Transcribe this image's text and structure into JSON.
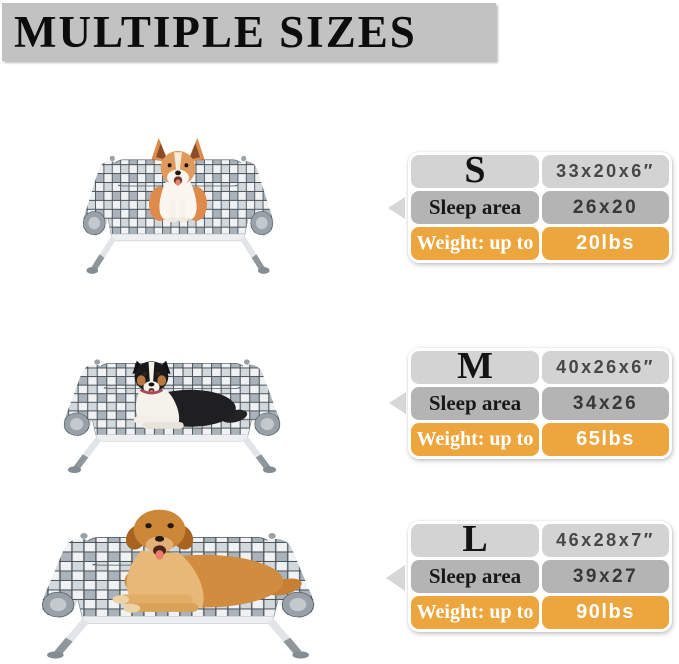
{
  "header": {
    "title": "MULTIPLE SIZES"
  },
  "colors": {
    "banner_bg": "#c2c2c2",
    "row_light": "#d3d3d3",
    "row_medium": "#b4b4b4",
    "accent_orange": "#eda63e",
    "arrow": "#d7d7d7"
  },
  "icons": {
    "pointer": "triangle-left-icon"
  },
  "sizes": [
    {
      "label": "S",
      "dimensions": "33x20x6″",
      "sleep_area_label": "Sleep area",
      "sleep_area": "26x20",
      "weight_label": "Weight: up to",
      "weight": "20lbs",
      "photo": "corgi-on-elevated-plaid-dog-bed"
    },
    {
      "label": "M",
      "dimensions": "40x26x6″",
      "sleep_area_label": "Sleep area",
      "sleep_area": "34x26",
      "weight_label": "Weight: up to",
      "weight": "65lbs",
      "photo": "australian-shepherd-on-elevated-plaid-dog-bed"
    },
    {
      "label": "L",
      "dimensions": "46x28x7″",
      "sleep_area_label": "Sleep area",
      "sleep_area": "39x27",
      "weight_label": "Weight: up to",
      "weight": "90lbs",
      "photo": "golden-retriever-on-elevated-plaid-dog-bed"
    }
  ]
}
